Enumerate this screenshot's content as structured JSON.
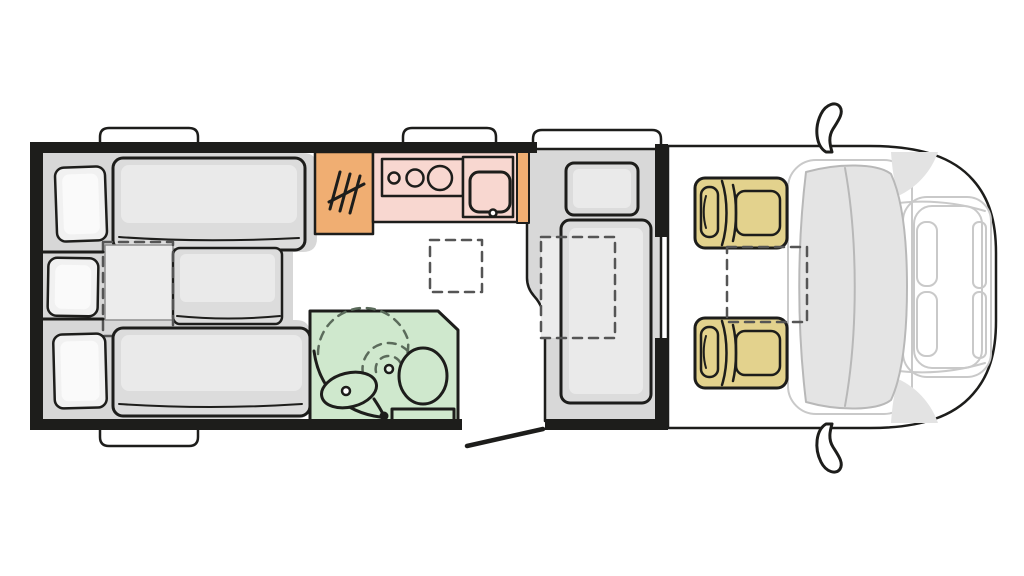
{
  "diagram": {
    "kind": "motorhome-floor-plan-top-view",
    "features": [
      "rear-bed-top",
      "rear-bed-middle",
      "rear-bed-bottom",
      "bed-extension-dashed",
      "pillow-top",
      "pillow-middle",
      "pillow-bottom",
      "heater-cabinet",
      "heater-symbol",
      "kitchen-counter",
      "hob-three-burners",
      "kitchen-sink",
      "roof-vent-dashed",
      "washroom",
      "washroom-sink",
      "toilet",
      "shower-swing-dashed",
      "dinette-seat",
      "dinette-table-dashed",
      "entry-door-open",
      "cab-seat-driver",
      "cab-seat-passenger",
      "cab-table-dashed",
      "windshield",
      "hood",
      "headlights",
      "side-mirror-top",
      "side-mirror-bottom",
      "window-bump-bed-top",
      "window-bump-kitchen",
      "window-bump-dinette",
      "window-bump-bed-bottom"
    ]
  },
  "colors": {
    "wall": "#1d1d1b",
    "platform_gray": "#d7d7d7",
    "mattress_gray": "#dcdcdc",
    "mattress_highlight": "#eaeaea",
    "bed_extension": "#ececec",
    "pillow": "#f1f1f1",
    "pillow_highlight": "#fafafa",
    "kitchen_orange": "#f0ae72",
    "counter_pink": "#f8d7d0",
    "bathroom_green": "#cfe8cd",
    "bathroom_light": "#e9f4e8",
    "seat_tan": "#e3d28d",
    "dinette_gray": "#d8d8d8",
    "dinette_table_fill": "#ececec",
    "windshield_gray": "#e4e4e4",
    "cowl_gray": "#e3e3e3",
    "white": "#ffffff"
  }
}
